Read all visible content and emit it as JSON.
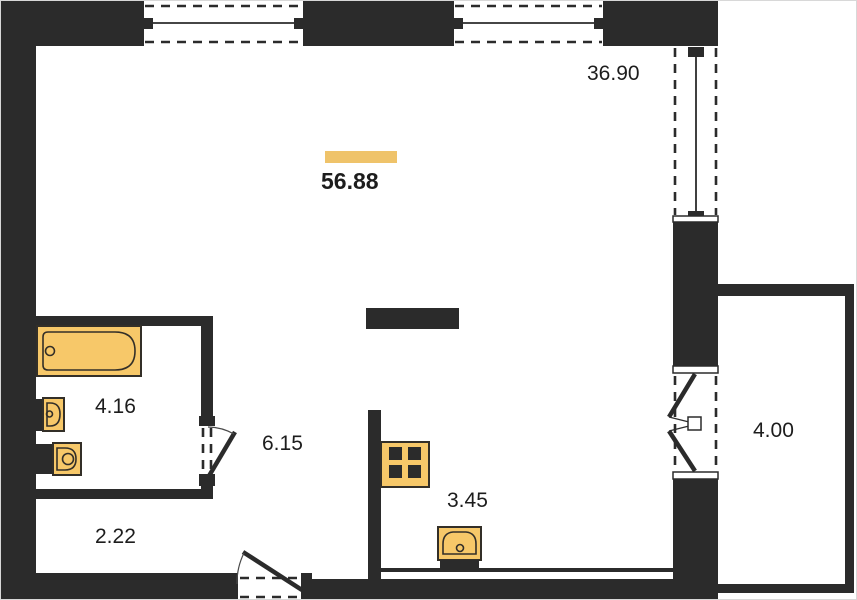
{
  "plan": {
    "title": "apartment floor plan",
    "total_area": {
      "value": "56.88",
      "highlighted": true
    },
    "rooms": {
      "living": {
        "name": "living-room",
        "area": "36.90"
      },
      "bathroom": {
        "name": "bathroom",
        "area": "4.16"
      },
      "hallway": {
        "name": "hallway",
        "area": "6.15"
      },
      "storage": {
        "name": "storage",
        "area": "2.22"
      },
      "kitchen": {
        "name": "kitchen",
        "area": "3.45"
      },
      "balcony": {
        "name": "balcony",
        "area": "4.00"
      }
    },
    "fixtures": [
      "bathtub",
      "washbasin",
      "toilet",
      "stove",
      "kitchen-sink",
      "kitchen-island"
    ],
    "openings": [
      "top-window-1",
      "top-window-2",
      "right-window",
      "balcony-french-door",
      "bathroom-door",
      "entry-door"
    ],
    "theme": {
      "wall_color": "#2b2b2b",
      "fixture_fill": "#f7c869",
      "fixture_stroke": "#332f28",
      "highlight_color": "#efc36a",
      "text_color": "#1d1d1d",
      "background": "#ffffff"
    }
  }
}
